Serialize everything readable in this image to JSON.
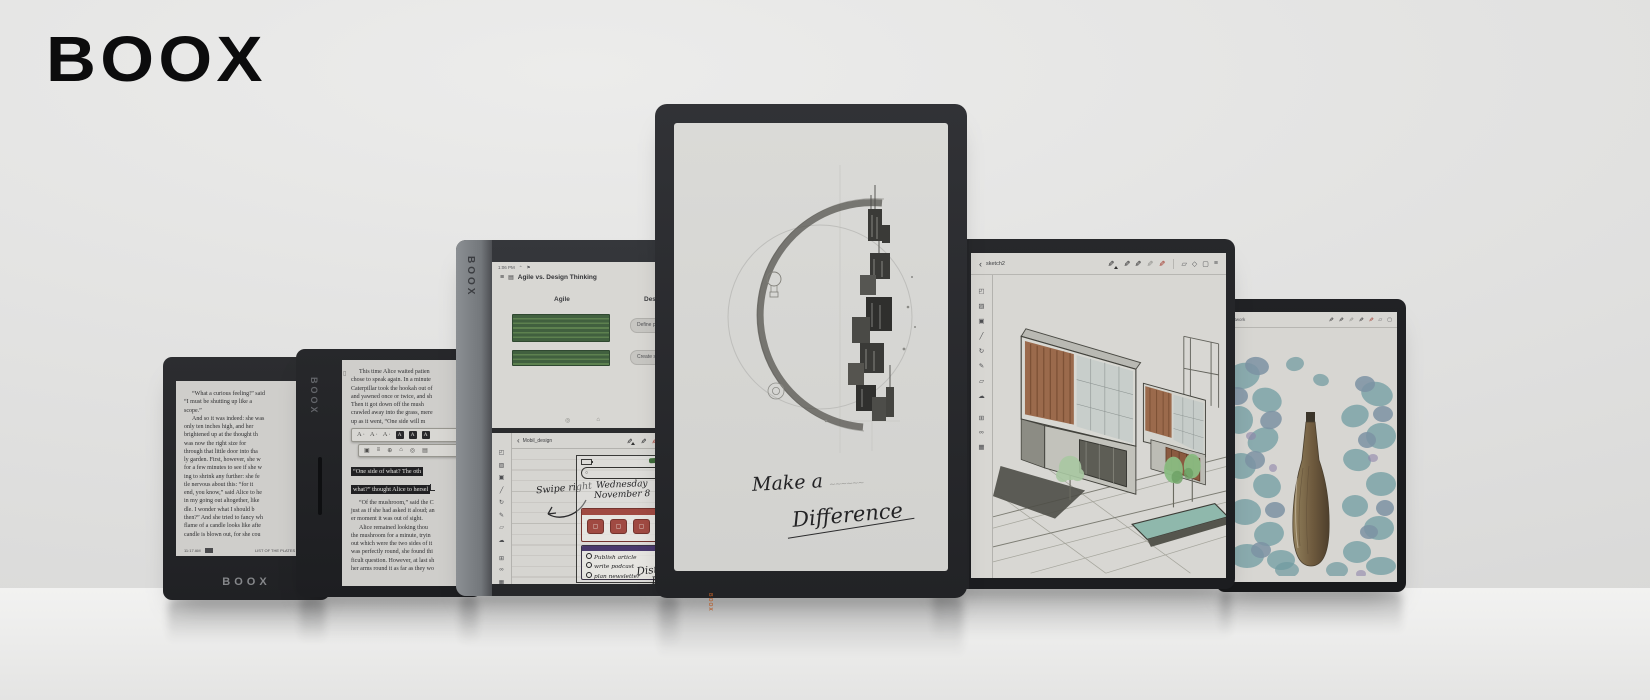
{
  "brand": {
    "logo": "BOOX"
  },
  "colors": {
    "accent_orange": "#b85c28",
    "bezel_dark": "#232427",
    "paper": "#d6d5d1",
    "highlight_green": "#41603f",
    "note_red": "#a04a42",
    "note_purple": "#4a3a6e"
  },
  "icons": {
    "menu": "≡",
    "doc": "▤",
    "back": "‹",
    "pen": "✎",
    "search": "◎",
    "home": "⌂",
    "clipboard": "▯",
    "select": "◰",
    "hatch": "▨",
    "frame": "▣",
    "line": "╱",
    "undo": "↻",
    "shapes": "▱",
    "cloud": "☁",
    "grid": "⊞",
    "link": "∞",
    "image": "▦",
    "eraser": "▭",
    "copy": "▣",
    "flower": "⊕",
    "circle": "◇",
    "square": "▢",
    "underline_style": "A",
    "highlight_style": "A",
    "magnifier": "○",
    "arrow_up": "⌃",
    "flag": "⚑"
  },
  "device1": {
    "para1": [
      "“What a curious feeling!” said",
      "“I must be shutting up like a",
      "scope.”"
    ],
    "para2": [
      "And so it was indeed: she was",
      "only ten inches high, and her",
      "brightened up at the thought th",
      "was now the right size for",
      "through that little door into tha",
      "ly garden. First, however, she w",
      "for a few minutes to see if she w",
      "ing to shrink any further: she fe",
      "tle nervous about this: “for it",
      "end, you know,” said Alice to he",
      "in my going out altogether, like",
      "dle. I wonder what I should b",
      "then?” And she tried to fancy wh",
      "flame of a candle looks like afte",
      "candle is blown out, for she cou"
    ],
    "status_time": "11:17 AM",
    "status_right": "LIST OF THE PLATES (16/35)",
    "brand_label": "BOOX"
  },
  "device2": {
    "side_brand": "BOOX",
    "para1": [
      "This time Alice waited patien",
      "chose to speak again. In a minute",
      "Caterpillar took the hookah out of",
      "and yawned once or twice, and sh",
      "Then it got down off the mush",
      "crawled away into the grass, mere",
      "up as it went, “One side will m"
    ],
    "highlight_line1": "“One side of what? The oth",
    "highlight_line2": "what?” thought Alice to hersel",
    "para2": [
      "“Of the mushroom,” said the C",
      "just as if she had asked it aloud; an",
      "er moment it was out of sight."
    ],
    "para3": [
      "Alice remained looking thou",
      "the mushroom for a minute, tryin",
      "out which were the two sides of it",
      "was perfectly round, she found thi",
      "ficult question. However, at last sh",
      "her arms round it as far as they wo"
    ]
  },
  "device3": {
    "side_brand": "BOOX",
    "status_time": "1:06 PM",
    "doc_title": "Agile vs. Design Thinking",
    "col_left": "Agile",
    "col_right": "Design Thinking",
    "btn_define": "Define problem",
    "btn_create": "Create solution",
    "note_title": "Mobil_design",
    "hw_date_line1": "Wednesday",
    "hw_date_line2": "November 8",
    "hw_swipe": "Swipe right",
    "checklist": [
      "Publish article",
      "write podcast",
      "plan newsletter"
    ],
    "hw_bottom_line1": "Distrib",
    "hw_bottom_line2": "Fre"
  },
  "device4": {
    "caption_line1": "Make a",
    "caption_scribble": "~~~~~~",
    "caption_line2": "Difference",
    "brand_label": "BOOX"
  },
  "device5": {
    "side_brand": "BOOX",
    "note_title": "sketch2"
  },
  "device6": {
    "note_title": "Artwork"
  }
}
